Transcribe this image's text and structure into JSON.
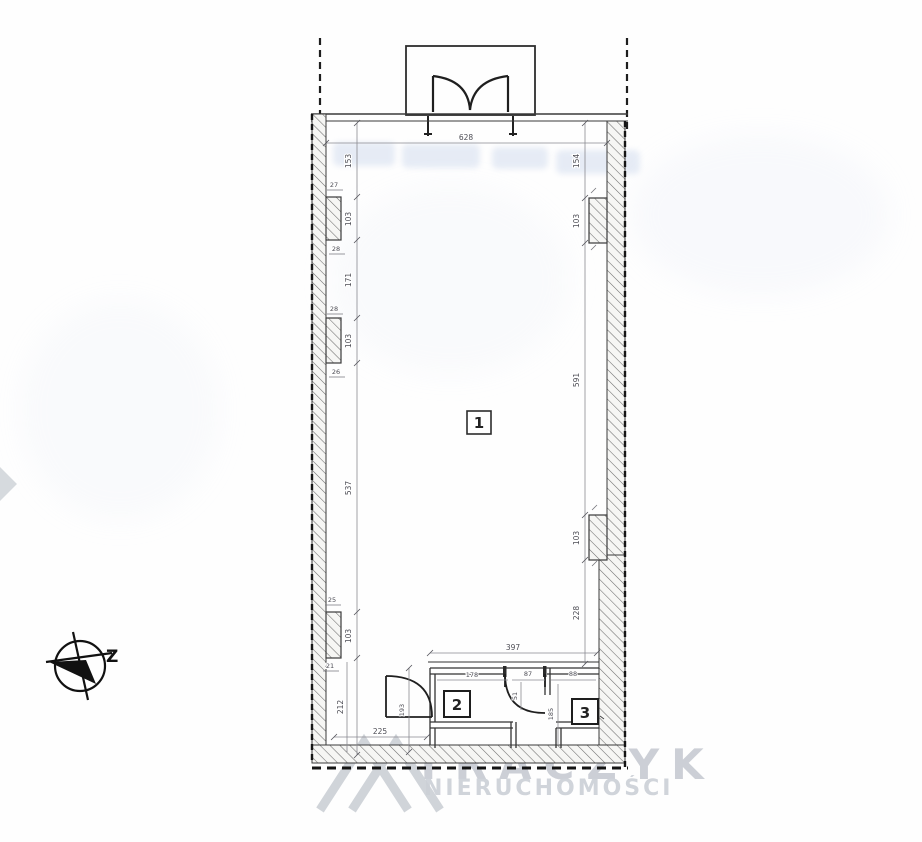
{
  "rooms": [
    {
      "label": "1"
    },
    {
      "label": "2"
    },
    {
      "label": "3"
    }
  ],
  "compass": {
    "direction_label": "Z"
  },
  "dimensions": {
    "top_width": "628",
    "left_chain": [
      "153",
      "103",
      "171",
      "103",
      "537",
      "103",
      "212"
    ],
    "left_pilasters": [
      "27",
      "28",
      "28",
      "26",
      "25",
      "21"
    ],
    "right_chain": [
      "154",
      "103",
      "591",
      "103",
      "228"
    ],
    "rooms_area": {
      "total_width": "397",
      "room2_width": "178",
      "mid_door_width": "87",
      "room3_width": "88",
      "height_left": "193",
      "inner_height_a": "51",
      "inner_height_b": "185",
      "bottom_left_width": "225"
    }
  },
  "watermark": {
    "brand": "TRACZYK",
    "subtitle": "NIERUCHOMOŚCI"
  },
  "colors": {
    "line": "#3c3c40",
    "dimension": "#55555c",
    "watermark_gray": "#c9cdd4",
    "ghost_blue": "#c9d5ea"
  }
}
